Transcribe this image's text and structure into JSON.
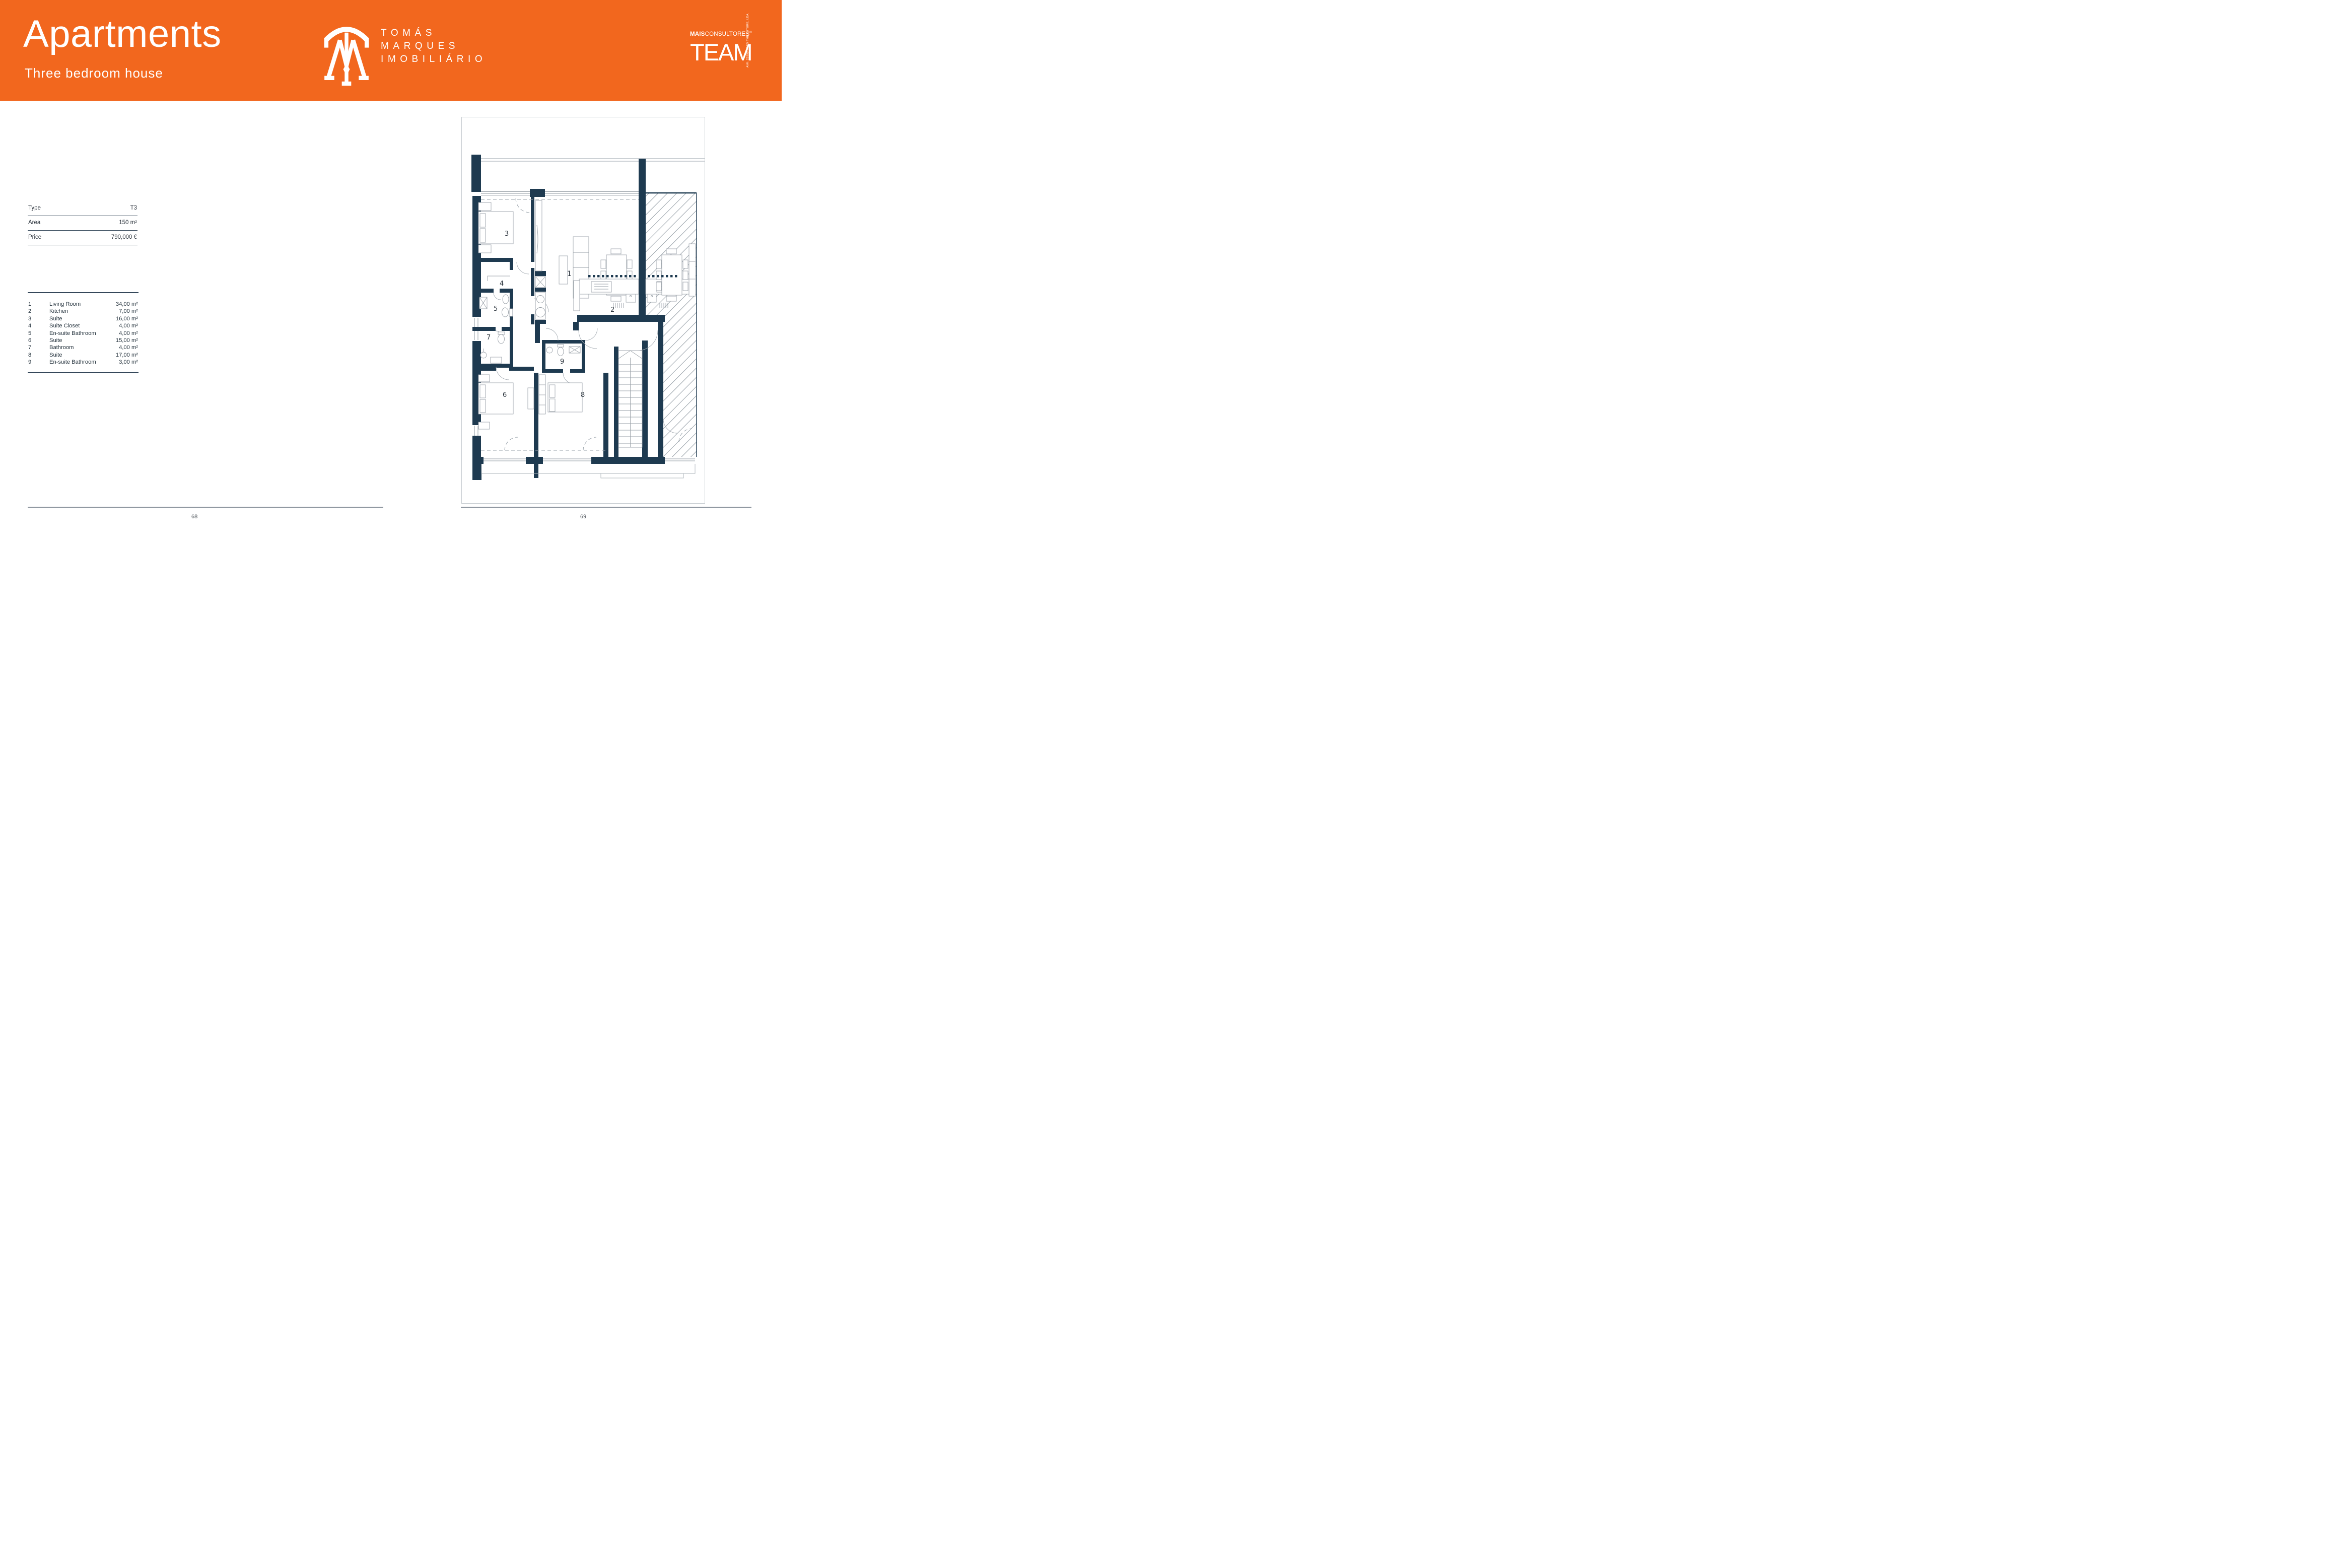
{
  "header": {
    "title": "Apartments",
    "subtitle": "Three bedroom house",
    "accent_color": "#f2671e",
    "brand": {
      "line1": "TOMÁS",
      "line2": "MARQUES",
      "line3": "IMOBILIÁRIO"
    },
    "consultores": {
      "bold": "MAIS",
      "rest": "CONSULTORES",
      "reg_mark": "®",
      "wordmark": "TEAM",
      "side_text": "AMI: 23990  SEED THE FUTURE, LDA."
    }
  },
  "specs": {
    "rows": [
      {
        "label": "Type",
        "value": "T3"
      },
      {
        "label": "Area",
        "value": "150 m²"
      },
      {
        "label": "Price",
        "value": "790,000 €"
      }
    ]
  },
  "rooms": [
    {
      "num": "1",
      "name": "Living Room",
      "area": "34,00 m²"
    },
    {
      "num": "2",
      "name": "Kitchen",
      "area": "7,00 m²"
    },
    {
      "num": "3",
      "name": "Suite",
      "area": "16,00 m²"
    },
    {
      "num": "4",
      "name": "Suite Closet",
      "area": "4,00 m²"
    },
    {
      "num": "5",
      "name": "En-suite Bathroom",
      "area": "4,00 m²"
    },
    {
      "num": "6",
      "name": "Suite",
      "area": "15,00 m²"
    },
    {
      "num": "7",
      "name": "Bathroom",
      "area": "4,00 m²"
    },
    {
      "num": "8",
      "name": "Suite",
      "area": "17,00 m²"
    },
    {
      "num": "9",
      "name": "En-suite Bathroom",
      "area": "3,00 m²"
    }
  ],
  "plan_colors": {
    "wall": "#1e3a50",
    "hatch": "#8a949d",
    "furniture": "#9aa1a8",
    "frame": "#c7ccd1"
  },
  "footer": {
    "left_page": "68",
    "right_page": "69"
  }
}
